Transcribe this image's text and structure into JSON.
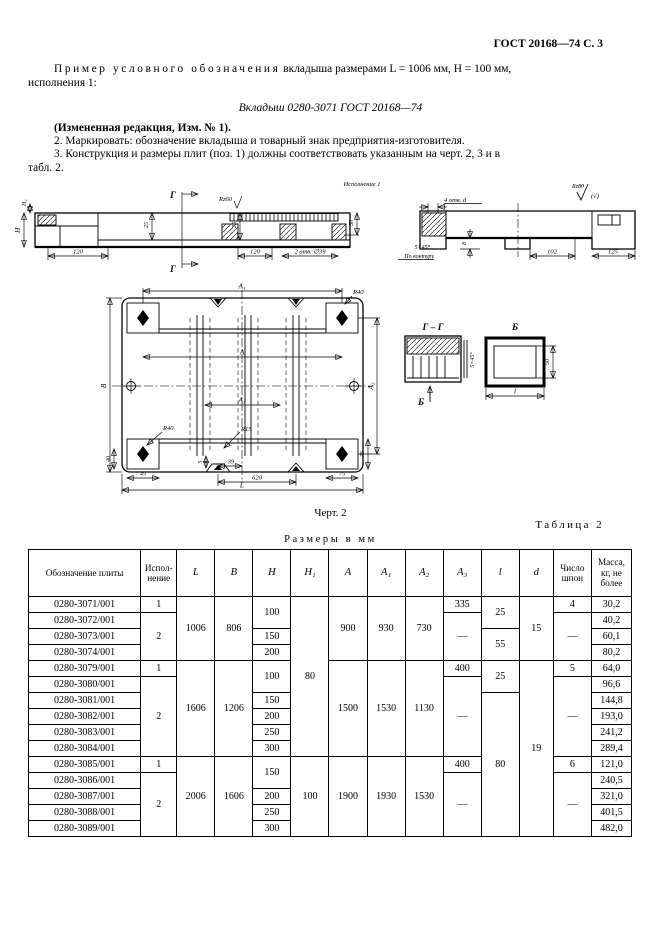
{
  "page_header": "ГОСТ 20168—74 С. 3",
  "intro": {
    "p1_spaced": "Пример условного обозначения",
    "p1_rest": " вкладыша размерами L = 1006 мм, Н = 100 мм,",
    "p1_line2": "исполнения 1:",
    "designation": "Вкладыш 0280-3071 ГОСТ 20168—74",
    "amended": "(Измененная редакция, Изм. № 1).",
    "item2": "2.  Маркировать: обозначение вкладыша и товарный знак предприятия-изготовителя.",
    "item3_line1": "3.  Конструкция и размеры плит (поз. 1) должны соответствовать указанным на черт. 2, 3 и в",
    "item3_line2": "табл. 2."
  },
  "fig": {
    "variant": "Исполнение 1",
    "caption": "Черт. 2",
    "s1": {
      "g": "Г",
      "h": "H",
      "h2": "H₂",
      "rz": "Rz60",
      "d25": "25",
      "d50": "50",
      "d120": "120",
      "holes": "2 отв. ∅39"
    },
    "s2": {
      "holes": "4 отв. d",
      "rz": "Rz80",
      "mark": "(√)",
      "chamfer": "5×45°",
      "contour": "По контуру",
      "d8": "8",
      "d102": "102",
      "d125": "125"
    },
    "plan": {
      "a1": "A₁",
      "a2": "A₂",
      "a": "A",
      "a3": "A₃",
      "b": "B",
      "L": "L",
      "r40": "R40",
      "r15": "R15",
      "d40": "40",
      "d45": "45",
      "d5": "5",
      "d39": "39",
      "d620": "620",
      "d75": "75"
    },
    "gg": {
      "title": "Г – Г",
      "chamfer": "5×45°",
      "b": "Б"
    },
    "bd": {
      "title": "Б",
      "l": "l",
      "d50": "50"
    }
  },
  "table": {
    "label": "Таблица 2",
    "units": "Размеры в мм",
    "headers": [
      "Обозначение плиты",
      "Испол-нение",
      "L",
      "B",
      "H",
      "H₁",
      "A",
      "A₁",
      "A₂",
      "A₃",
      "l",
      "d",
      "Число шпон",
      "Масса, кг, не более"
    ],
    "rows": [
      {
        "cells": [
          {
            "t": "0280-3071/001"
          },
          {
            "t": "1"
          },
          {
            "t": "1006",
            "rs": 4
          },
          {
            "t": "806",
            "rs": 4
          },
          {
            "t": "100",
            "rs": 2
          },
          {
            "t": "80",
            "rs": 10
          },
          {
            "t": "900",
            "rs": 4
          },
          {
            "t": "930",
            "rs": 4
          },
          {
            "t": "730",
            "rs": 4
          },
          {
            "t": "335"
          },
          {
            "t": "25",
            "rs": 2
          },
          {
            "t": "15",
            "rs": 4
          },
          {
            "t": "4"
          },
          {
            "t": "30,2"
          }
        ]
      },
      {
        "cells": [
          {
            "t": "0280-3072/001"
          },
          {
            "t": "2",
            "rs": 3
          },
          {
            "t": "—",
            "rs": 3
          },
          {
            "t": "—",
            "rs": 3
          },
          {
            "t": "40,2"
          }
        ]
      },
      {
        "cells": [
          {
            "t": "0280-3073/001"
          },
          {
            "t": "150"
          },
          {
            "t": "55",
            "rs": 2
          },
          {
            "t": "60,1"
          }
        ]
      },
      {
        "cells": [
          {
            "t": "0280-3074/001"
          },
          {
            "t": "200"
          },
          {
            "t": "80,2"
          }
        ]
      },
      {
        "cells": [
          {
            "t": "0280-3079/001"
          },
          {
            "t": "1"
          },
          {
            "t": "1606",
            "rs": 6
          },
          {
            "t": "1206",
            "rs": 6
          },
          {
            "t": "100",
            "rs": 2
          },
          {
            "t": "1500",
            "rs": 6
          },
          {
            "t": "1530",
            "rs": 6
          },
          {
            "t": "1130",
            "rs": 6
          },
          {
            "t": "400"
          },
          {
            "t": "25",
            "rs": 2
          },
          {
            "t": "19",
            "rs": 11
          },
          {
            "t": "5"
          },
          {
            "t": "64,0"
          }
        ]
      },
      {
        "cells": [
          {
            "t": "0280-3080/001"
          },
          {
            "t": "2",
            "rs": 5
          },
          {
            "t": "—",
            "rs": 5
          },
          {
            "t": "—",
            "rs": 5
          },
          {
            "t": "96,6"
          }
        ]
      },
      {
        "cells": [
          {
            "t": "0280-3081/001"
          },
          {
            "t": "150"
          },
          {
            "t": "80",
            "rs": 9
          },
          {
            "t": "144,8"
          }
        ]
      },
      {
        "cells": [
          {
            "t": "0280-3082/001"
          },
          {
            "t": "200"
          },
          {
            "t": "193,0"
          }
        ]
      },
      {
        "cells": [
          {
            "t": "0280-3083/001"
          },
          {
            "t": "250"
          },
          {
            "t": "241,2"
          }
        ]
      },
      {
        "cells": [
          {
            "t": "0280-3084/001"
          },
          {
            "t": "300"
          },
          {
            "t": "289,4"
          }
        ]
      },
      {
        "cells": [
          {
            "t": "0280-3085/001"
          },
          {
            "t": "1"
          },
          {
            "t": "2006",
            "rs": 5
          },
          {
            "t": "1606",
            "rs": 5
          },
          {
            "t": "150",
            "rs": 2
          },
          {
            "t": "100",
            "rs": 5
          },
          {
            "t": "1900",
            "rs": 5
          },
          {
            "t": "1930",
            "rs": 5
          },
          {
            "t": "1530",
            "rs": 5
          },
          {
            "t": "400"
          },
          {
            "t": "6"
          },
          {
            "t": "121,0"
          }
        ]
      },
      {
        "cells": [
          {
            "t": "0280-3086/001"
          },
          {
            "t": "2",
            "rs": 4
          },
          {
            "t": "—",
            "rs": 4
          },
          {
            "t": "—",
            "rs": 4
          },
          {
            "t": "240,5"
          }
        ]
      },
      {
        "cells": [
          {
            "t": "0280-3087/001"
          },
          {
            "t": "200"
          },
          {
            "t": "321,0"
          }
        ]
      },
      {
        "cells": [
          {
            "t": "0280-3088/001"
          },
          {
            "t": "250"
          },
          {
            "t": "401,5"
          }
        ]
      },
      {
        "cells": [
          {
            "t": "0280-3089/001"
          },
          {
            "t": "300"
          },
          {
            "t": "482,0"
          }
        ]
      }
    ]
  }
}
